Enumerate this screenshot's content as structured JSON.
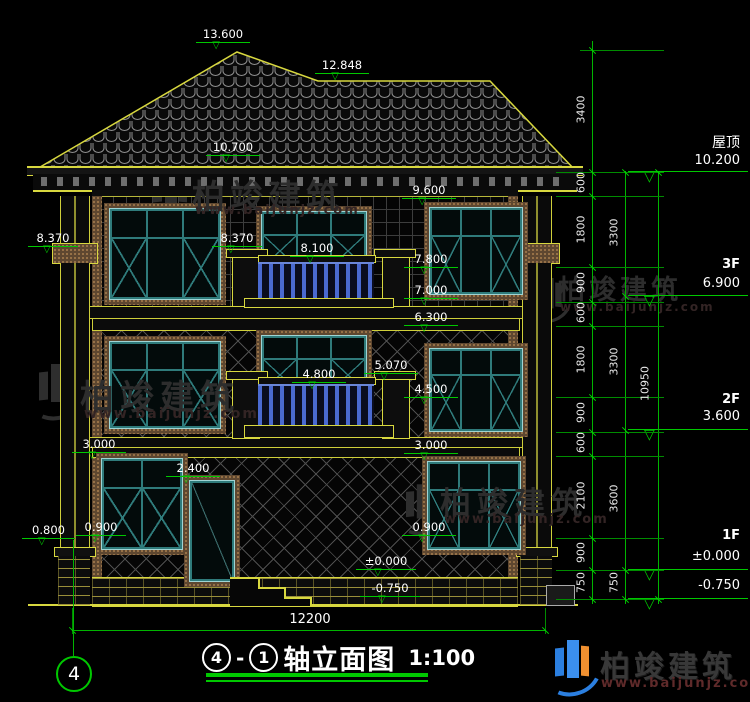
{
  "brand": {
    "name": "柏竣建筑",
    "url": "www.baijunjz.com"
  },
  "title": {
    "bubble_left": "4",
    "dash": "-",
    "bubble_right": "1",
    "name": "轴立面图",
    "scale": "1:100"
  },
  "axis_bubble": "4",
  "levels": {
    "roof_label": "屋顶",
    "roof_elev": "10.200",
    "f3_label": "3F",
    "f3_elev": "6.900",
    "f2_label": "2F",
    "f2_elev": "3.600",
    "f1_label": "1F",
    "f1_elev": "±0.000",
    "ground_elev": "-0.750"
  },
  "markers": [
    "13.600",
    "12.848",
    "10.700",
    "8.370",
    "8.370",
    "9.600",
    "8.100",
    "7.800",
    "7.000",
    "6.300",
    "5.070",
    "4.800",
    "4.500",
    "3.000",
    "3.000",
    "2.400",
    "0.800",
    "0.900",
    "0.900",
    "±0.000",
    "-0.750"
  ],
  "dims": {
    "inner": [
      "3400",
      "600",
      "1800",
      "900",
      "600",
      "1800",
      "900",
      "600",
      "2100",
      "900",
      "750"
    ],
    "mid": [
      "3300",
      "3300",
      "3600",
      "750"
    ],
    "total_height": "10950",
    "total_width": "12200"
  },
  "colors": {
    "dim_green": "#00c800",
    "outline_yellow": "#d8d83f",
    "frame_teal": "#2f7b7b",
    "baluster_blue": "#4a6ad0",
    "brand_blue": "#2b7fe0",
    "brand_orange": "#f09030"
  }
}
